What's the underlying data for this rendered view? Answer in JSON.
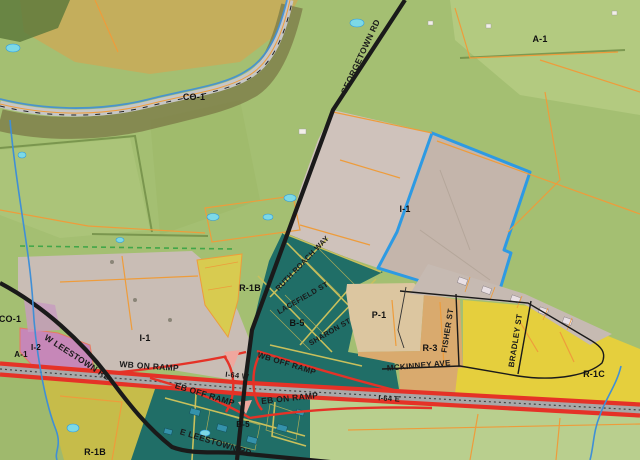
{
  "map": {
    "type": "zoning-aerial-map",
    "zone_labels": [
      {
        "text": "CO-1",
        "x": 194,
        "y": 100
      },
      {
        "text": "A-1",
        "x": 540,
        "y": 42
      },
      {
        "text": "I-1",
        "x": 405,
        "y": 212
      },
      {
        "text": "I-1",
        "x": 145,
        "y": 341
      },
      {
        "text": "CO-1",
        "x": 10,
        "y": 322
      },
      {
        "text": "A-1",
        "x": 21,
        "y": 357,
        "size": 8
      },
      {
        "text": "I-2",
        "x": 36,
        "y": 350,
        "size": 8
      },
      {
        "text": "R-1B",
        "x": 250,
        "y": 291
      },
      {
        "text": "B-5",
        "x": 297,
        "y": 326
      },
      {
        "text": "P-1",
        "x": 379,
        "y": 318
      },
      {
        "text": "R-3",
        "x": 430,
        "y": 351
      },
      {
        "text": "R-1C",
        "x": 594,
        "y": 377
      },
      {
        "text": "B-5",
        "x": 243,
        "y": 427,
        "size": 8
      },
      {
        "text": "R-1B",
        "x": 95,
        "y": 455
      }
    ],
    "street_labels": [
      {
        "text": "GEORGETOWN RD",
        "x": 363,
        "y": 58,
        "rotate": -65,
        "size": 8.5
      },
      {
        "text": "W LEESTOWN RD",
        "x": 76,
        "y": 360,
        "rotate": 33,
        "size": 8.5
      },
      {
        "text": "E LEESTOWN RD",
        "x": 215,
        "y": 445,
        "rotate": 17,
        "size": 8.5
      },
      {
        "text": "WB ON RAMP",
        "x": 149,
        "y": 369,
        "rotate": 4,
        "size": 8.5
      },
      {
        "text": "EB OFF RAMP",
        "x": 204,
        "y": 397,
        "rotate": 17,
        "size": 8.5
      },
      {
        "text": "EB ON RAMP",
        "x": 290,
        "y": 401,
        "rotate": -6,
        "size": 8.5
      },
      {
        "text": "WB OFF RAMP",
        "x": 286,
        "y": 366,
        "rotate": 17,
        "size": 8
      },
      {
        "text": "I-64 W",
        "x": 237,
        "y": 378,
        "rotate": 6,
        "size": 7.5
      },
      {
        "text": "I-64 E",
        "x": 389,
        "y": 401,
        "rotate": 4,
        "size": 7.5
      },
      {
        "text": "MCKINNEY AVE",
        "x": 419,
        "y": 368,
        "rotate": -5,
        "size": 8
      },
      {
        "text": "FISHER ST",
        "x": 450,
        "y": 331,
        "rotate": -81,
        "size": 8
      },
      {
        "text": "BRADLEY ST",
        "x": 518,
        "y": 341,
        "rotate": -81,
        "size": 8
      },
      {
        "text": "RUTH ROACH WAY",
        "x": 304,
        "y": 265,
        "rotate": -46,
        "size": 7.5
      },
      {
        "text": "LACEFIELD ST",
        "x": 304,
        "y": 300,
        "rotate": -30,
        "size": 7.5
      },
      {
        "text": "SHARON ST",
        "x": 331,
        "y": 334,
        "rotate": -30,
        "size": 7.5
      }
    ],
    "colors": {
      "field_green": "#a4bf72",
      "field_green_light": "#b8cd85",
      "field_green_pale": "#b9cf8e",
      "field_yellow": "#c4ae5c",
      "trees_dark": "#5f7a3c",
      "co1_band": "#7d7d48",
      "road_gray": "#c6c6c6",
      "zone_i1": "#c9bdb5",
      "zone_i1_top": "#cfc2bb",
      "zone_i1_field": "#c4b5ab",
      "zone_i2": "#c687b8",
      "zone_r1b": "#d8cb50",
      "zone_r1b_south": "#c6bc4a",
      "zone_b5": "#206e67",
      "zone_p1": "#dcc6a0",
      "zone_r3": "#d9aa6e",
      "zone_r1c": "#e5cf3d",
      "strip_gray": "#c6bab2",
      "road_black": "#1a1a1a",
      "highway_red": "#e53227",
      "parcel_orange": "#ee9c3b",
      "teal_street_yellow": "#c9c05c",
      "water_blue": "#3f8fd6",
      "parcel_blue": "#2d9ae3",
      "dashed_green": "#42a648",
      "pond_cyan": "#7cd9e6",
      "label_black": "#111111"
    }
  }
}
